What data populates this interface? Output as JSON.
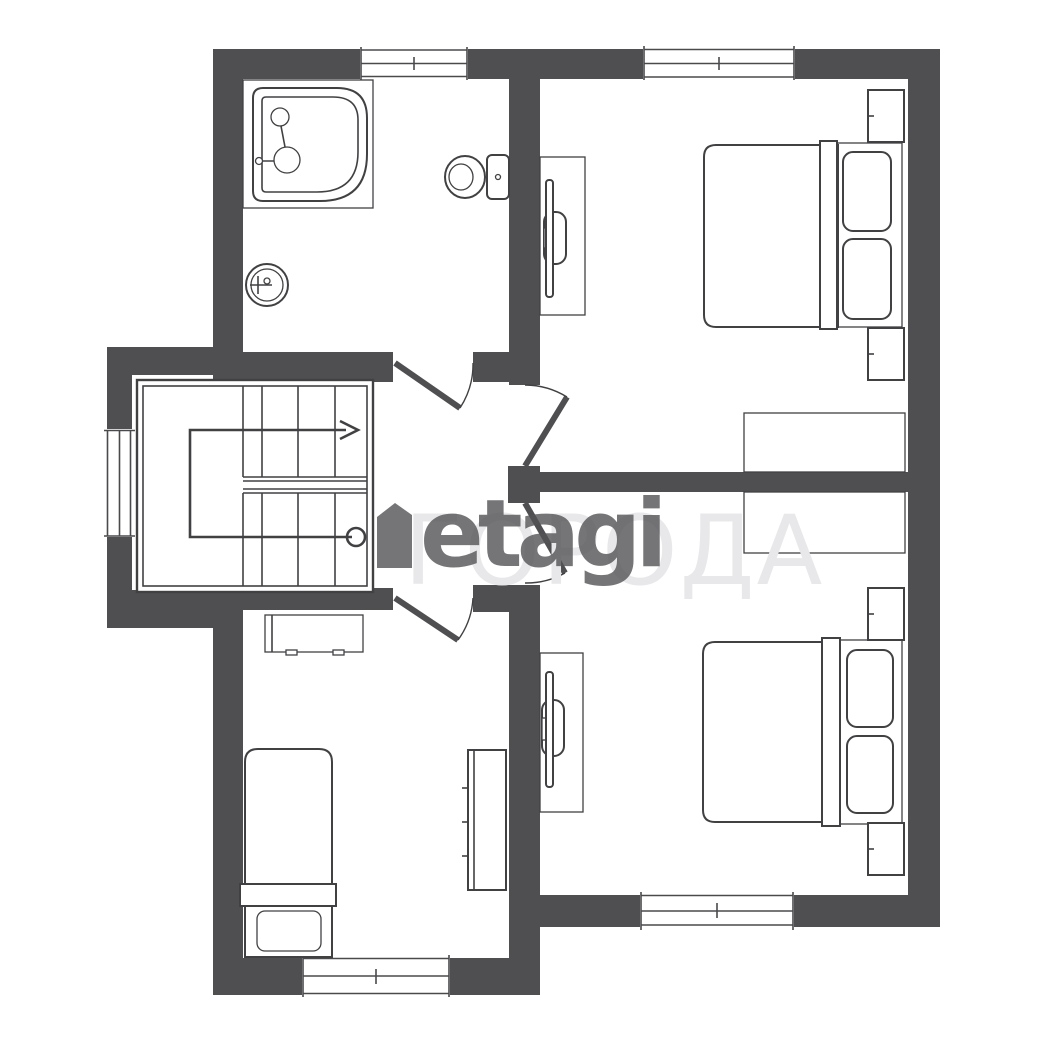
{
  "palette": {
    "wall": "#4f4f51",
    "line": "#414144",
    "windowLine": "#4a4a4d",
    "floor": "#ffffff",
    "wmDark": "rgba(82,82,85,0.8)",
    "wmLight": "#e8e8ea"
  },
  "watermark": {
    "logo": "etagi",
    "overlay": "ГОРОДА"
  },
  "plan": {
    "type": "apartment-floor-plan",
    "rooms": [
      {
        "id": "bathroom",
        "fixtures": [
          "bathtub",
          "sink",
          "toilet"
        ]
      },
      {
        "id": "bedroom-top-right",
        "furniture": [
          "double-bed",
          "pillows",
          "nightstand-top",
          "nightstand-bottom",
          "wardrobe",
          "tv-cabinet",
          "tv"
        ]
      },
      {
        "id": "bedroom-bottom-right",
        "furniture": [
          "double-bed",
          "pillows",
          "nightstand-top",
          "nightstand-bottom",
          "wardrobe",
          "tv-cabinet",
          "tv"
        ]
      },
      {
        "id": "room-bottom-left",
        "furniture": [
          "single-bed",
          "pillow",
          "desk",
          "shelf-unit"
        ]
      },
      {
        "id": "stair-hall",
        "features": [
          "staircase",
          "direction-arrow",
          "landing"
        ]
      }
    ],
    "window_count": 5,
    "door_count": 4
  }
}
